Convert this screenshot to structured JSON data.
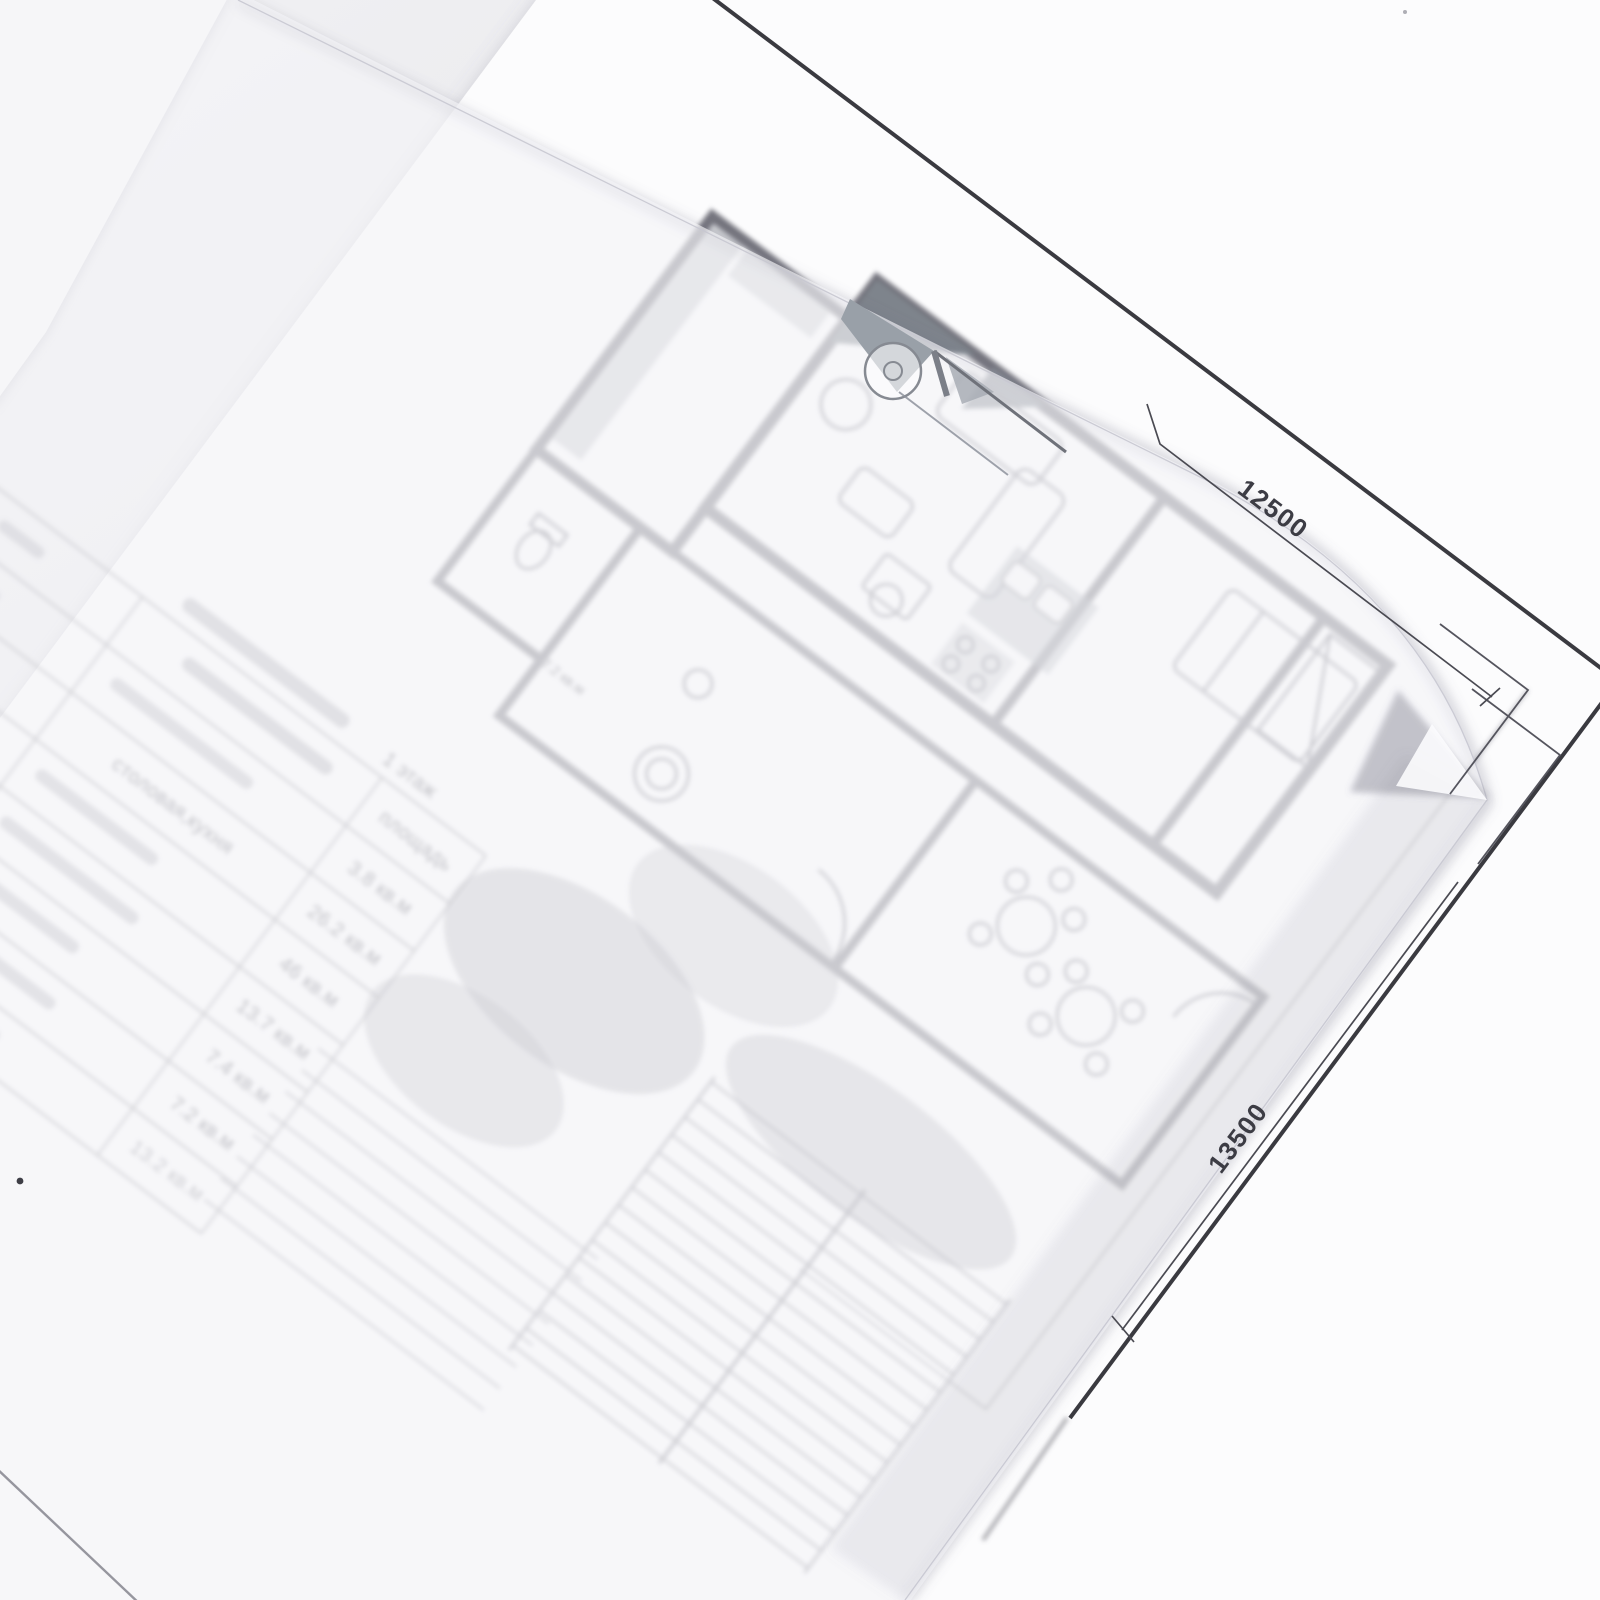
{
  "scene": {
    "kind": "photograph of architectural floor-plan sheets",
    "layers": [
      "white drawing sheet with printed plan",
      "second sheet corner top-left",
      "translucent tracing paper overlay"
    ]
  },
  "drawing": {
    "dimensions": {
      "top": "12500",
      "side": "13500"
    },
    "plan_labels": [
      {
        "text": "7.2 кв.м"
      }
    ],
    "room_schedule": {
      "title_visible": "1 этаж",
      "header_area": "площадь",
      "rows": [
        {
          "name": "",
          "area": "3.8 кв.м"
        },
        {
          "name": "столовая,кухня",
          "area": "26.2 кв.м"
        },
        {
          "name": "",
          "area": "46 кв.м"
        },
        {
          "name": "",
          "area": "13.7 кв.м"
        },
        {
          "name": "",
          "area": "7.4 кв.м"
        },
        {
          "name": "",
          "area": "7.2 кв.м"
        },
        {
          "name": "",
          "area": "13.2 кв.м"
        }
      ]
    }
  },
  "colors": {
    "background": "#e9e9ec",
    "paper": "#fcfcfd",
    "tracing_paper": "#f4f4f8",
    "frame_line": "#3a3a40",
    "pencil_gray": "#76767f",
    "dim_text": "#3c3c44"
  }
}
